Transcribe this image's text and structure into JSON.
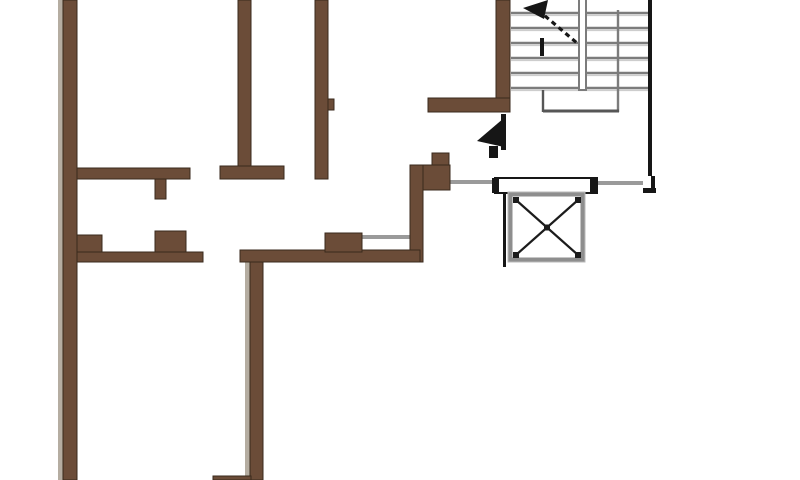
{
  "canvas": {
    "width": 800,
    "height": 480,
    "background": "#ffffff"
  },
  "colors": {
    "wall_fill": "#6b4c38",
    "wall_edge": "#3a2a1c",
    "wall_highlight": "#b5ada1",
    "stair_line": "#7c7c7c",
    "stair_line_light": "#cdcdcd",
    "stair_line_dark": "#565656",
    "thin_black": "#161616",
    "gray_line": "#9a9a9a",
    "elevator_border": "#8e8e8e",
    "x_color": "#1c1c1c"
  },
  "highlight_strips": [
    {
      "name": "left-wall-shadow-strip",
      "x": 58,
      "y": 0,
      "w": 5,
      "h": 480
    },
    {
      "name": "lower-vertical-shadow-strip",
      "x": 245,
      "y": 262,
      "w": 5,
      "h": 218
    }
  ],
  "walls": [
    {
      "name": "left-exterior-wall",
      "x": 63,
      "y": 0,
      "w": 14,
      "h": 480
    },
    {
      "name": "top-interior-wall-2",
      "x": 238,
      "y": 0,
      "w": 13,
      "h": 168
    },
    {
      "name": "mid-band-right-segment",
      "x": 220,
      "y": 166,
      "w": 64,
      "h": 13
    },
    {
      "name": "top-interior-wall-3",
      "x": 315,
      "y": 0,
      "w": 13,
      "h": 179
    },
    {
      "name": "wall-3-tick",
      "x": 328,
      "y": 99,
      "w": 6,
      "h": 11
    },
    {
      "name": "mid-band-left-segment",
      "x": 77,
      "y": 168,
      "w": 113,
      "h": 11
    },
    {
      "name": "mid-band-stub",
      "x": 155,
      "y": 179,
      "w": 11,
      "h": 20
    },
    {
      "name": "stair-left-wall",
      "x": 496,
      "y": 0,
      "w": 14,
      "h": 112
    },
    {
      "name": "stair-bottom-wall",
      "x": 428,
      "y": 98,
      "w": 82,
      "h": 14
    },
    {
      "name": "corridor-corner-top",
      "x": 432,
      "y": 153,
      "w": 17,
      "h": 13
    },
    {
      "name": "corridor-corner-block",
      "x": 410,
      "y": 165,
      "w": 40,
      "h": 25
    },
    {
      "name": "corridor-vertical-wall",
      "x": 410,
      "y": 165,
      "w": 13,
      "h": 97
    },
    {
      "name": "lower-wall-right-segment",
      "x": 240,
      "y": 250,
      "w": 180,
      "h": 12
    },
    {
      "name": "lower-wall-pier-mid",
      "x": 325,
      "y": 233,
      "w": 37,
      "h": 19
    },
    {
      "name": "lower-wall-left-segment",
      "x": 77,
      "y": 252,
      "w": 126,
      "h": 10
    },
    {
      "name": "lower-wall-pier-left",
      "x": 77,
      "y": 235,
      "w": 25,
      "h": 17
    },
    {
      "name": "lower-wall-pier-center",
      "x": 155,
      "y": 231,
      "w": 31,
      "h": 21
    },
    {
      "name": "lower-vertical-wall",
      "x": 250,
      "y": 262,
      "w": 13,
      "h": 218
    },
    {
      "name": "bottom-edge-stub",
      "x": 213,
      "y": 476,
      "w": 38,
      "h": 4
    }
  ],
  "gray_lines": [
    {
      "name": "corridor-opening-left",
      "x": 448,
      "y": 180,
      "w": 49,
      "h": 4
    },
    {
      "name": "corridor-opening-right",
      "x": 597,
      "y": 181,
      "w": 46,
      "h": 4
    },
    {
      "name": "interior-opening",
      "x": 362,
      "y": 235,
      "w": 48,
      "h": 4
    }
  ],
  "black_segments": [
    {
      "name": "stair-right-wall",
      "x": 648,
      "y": 0,
      "w": 4,
      "h": 176
    },
    {
      "name": "stair-right-wall-jog",
      "x": 651,
      "y": 176,
      "w": 4,
      "h": 14
    },
    {
      "name": "stair-right-wall-foot",
      "x": 643,
      "y": 188,
      "w": 13,
      "h": 5
    },
    {
      "name": "shaft-left-line",
      "x": 503,
      "y": 192,
      "w": 3,
      "h": 75
    }
  ],
  "stairs": {
    "x1": 511,
    "x2": 648,
    "treads_y": [
      13,
      28,
      43,
      58,
      73,
      88
    ],
    "divider": {
      "x": 578,
      "w": 9,
      "y1": 0,
      "y2": 90
    },
    "inner_rail": {
      "x": 618,
      "y1": 10,
      "y2": 112
    },
    "landing": {
      "vx": 543,
      "vy1": 90,
      "vy2": 112,
      "hx1": 543,
      "hx2": 619,
      "hy": 111
    },
    "arrow": {
      "head": "523,8 548,0 544,19",
      "line": {
        "x1": 538,
        "y1": 10,
        "x2": 577,
        "y2": 43
      },
      "tail": {
        "x1": 542,
        "y1": 38,
        "x2": 542,
        "y2": 56
      }
    }
  },
  "elevator": {
    "frame": {
      "x": 495,
      "y": 178,
      "w": 102,
      "h": 15
    },
    "caps": [
      {
        "x": 492,
        "y": 178,
        "w": 7,
        "h": 15
      },
      {
        "x": 590,
        "y": 178,
        "w": 7,
        "h": 15
      }
    ],
    "shaft": {
      "x": 508,
      "y": 192,
      "w": 77,
      "h": 70
    },
    "inner": {
      "x": 516,
      "y": 200,
      "w": 62,
      "h": 55
    }
  },
  "entry_arrow": {
    "triangle": "504,118 504,147 477,141",
    "bar": {
      "x": 501,
      "y": 114,
      "w": 5,
      "h": 36
    },
    "foot": {
      "x": 489,
      "y": 146,
      "w": 9,
      "h": 12
    }
  }
}
